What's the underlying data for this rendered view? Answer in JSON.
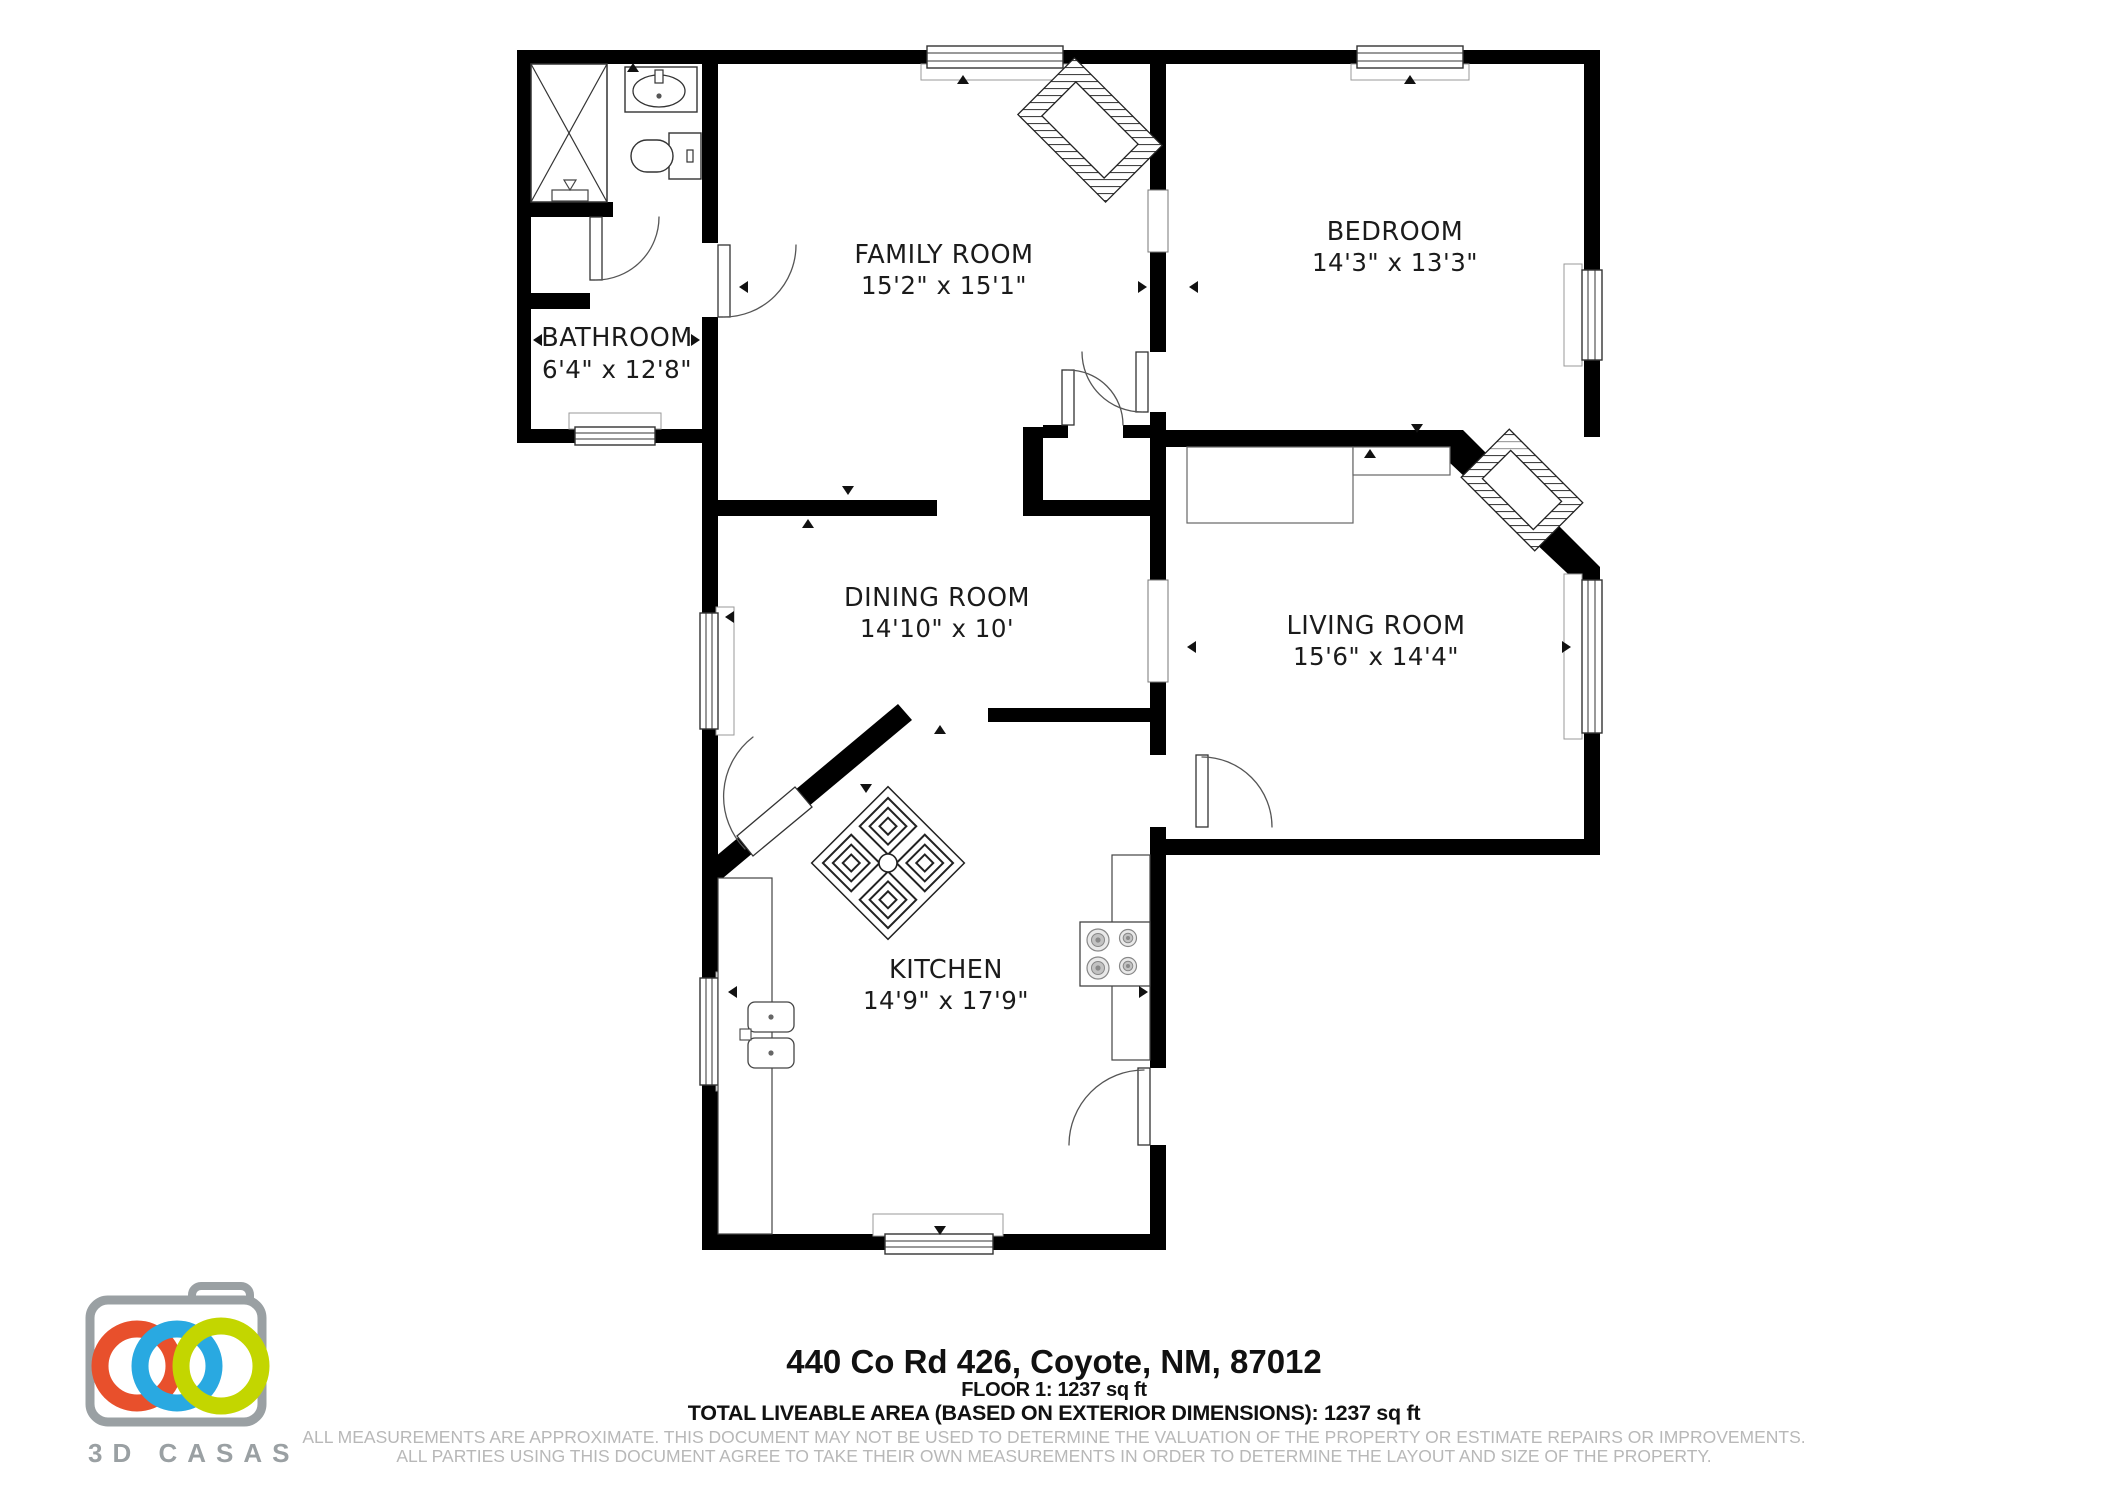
{
  "plan": {
    "rooms": [
      {
        "name": "FAMILY ROOM",
        "dims": "15'2\" x 15'1\""
      },
      {
        "name": "BEDROOM",
        "dims": "14'3\" x 13'3\""
      },
      {
        "name": "BATHROOM",
        "dims": "6'4\" x 12'8\""
      },
      {
        "name": "DINING ROOM",
        "dims": "14'10\" x 10'"
      },
      {
        "name": "LIVING ROOM",
        "dims": "15'6\" x 14'4\""
      },
      {
        "name": "KITCHEN",
        "dims": "14'9\" x 17'9\""
      }
    ],
    "wall_color": "#000000"
  },
  "footer": {
    "address": "440 Co Rd 426, Coyote, NM, 87012",
    "floor_line": "FLOOR 1: 1237 sq ft",
    "total_line": "TOTAL LIVEABLE AREA (BASED ON EXTERIOR DIMENSIONS): 1237 sq ft",
    "disclaimer_line1": "ALL MEASUREMENTS ARE APPROXIMATE. THIS DOCUMENT MAY NOT BE USED TO DETERMINE THE VALUATION OF THE PROPERTY OR ESTIMATE REPAIRS OR IMPROVEMENTS.",
    "disclaimer_line2": "ALL PARTIES USING THIS DOCUMENT AGREE TO TAKE THEIR OWN MEASUREMENTS IN ORDER TO DETERMINE THE LAYOUT AND SIZE OF THE PROPERTY."
  },
  "logo": {
    "brand": "3D CASAS",
    "colors": {
      "orange": "#e8502c",
      "blue": "#29a9e1",
      "green": "#c3d600",
      "gray": "#9aa0a3"
    }
  }
}
